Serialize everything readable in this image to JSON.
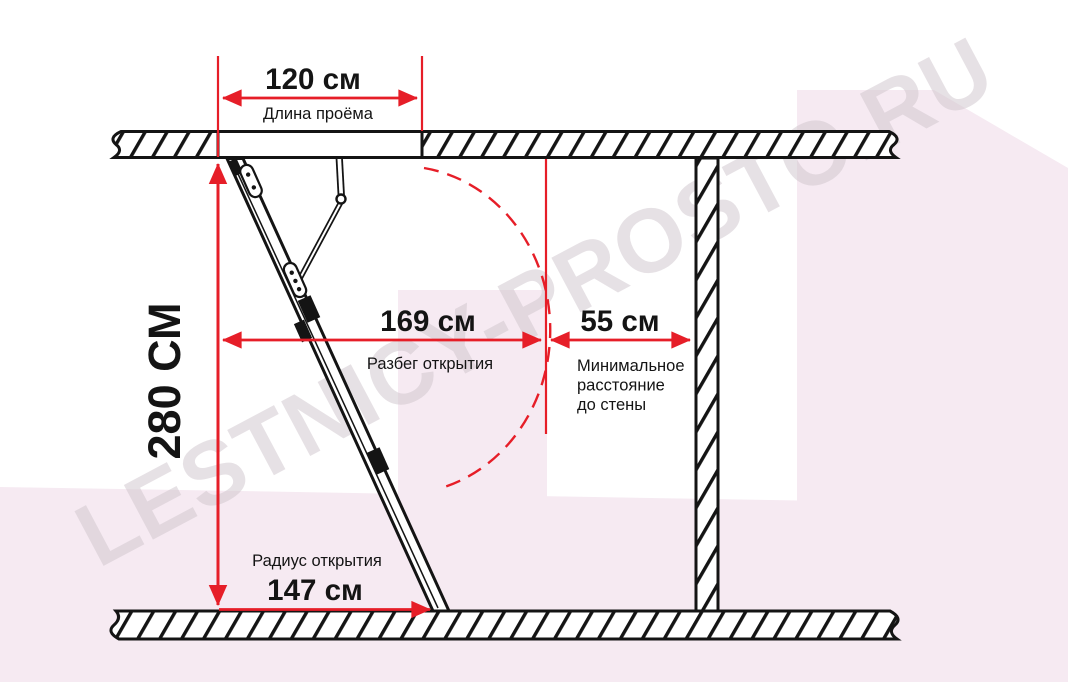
{
  "watermark_text": "LESTNICY-PROSTO.RU",
  "dims": {
    "opening_length": {
      "value": "120 см",
      "label": "Длина проёма"
    },
    "ceiling_height": {
      "value": "280 СМ"
    },
    "opening_span": {
      "value": "169 см",
      "label": "Разбег открытия"
    },
    "min_wall_distance": {
      "value": "55 см",
      "label_lines": [
        "Минимальное",
        "расстояние",
        "до стены"
      ]
    },
    "opening_radius": {
      "value": "147 см",
      "label": "Радиус открытия"
    }
  },
  "colors": {
    "dimension_red": "#e61e28",
    "line_black": "#141414",
    "background_pink": "#f6eaf2",
    "watermark_gray": "#cfc5cc"
  }
}
